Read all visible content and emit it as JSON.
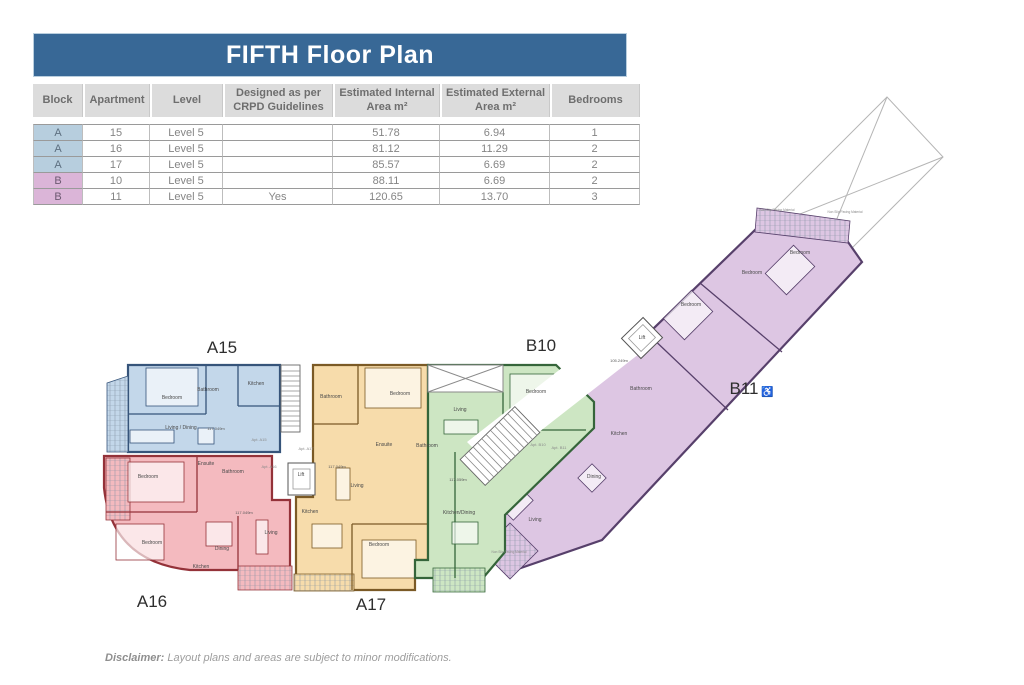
{
  "title": "FIFTH Floor Plan",
  "colors": {
    "titlebar": "#386896",
    "blockA": "#b7cede",
    "blockB": "#dbb5d8"
  },
  "table": {
    "headers": [
      "Block",
      "Apartment",
      "Level",
      "Designed as per CRPD Guidelines",
      "Estimated Internal Area m²",
      "Estimated External Area m²",
      "Bedrooms"
    ],
    "col_widths": [
      50,
      67,
      73,
      110,
      107,
      110,
      90
    ],
    "rows": [
      {
        "block": "A",
        "apartment": "15",
        "level": "Level 5",
        "crpd": "",
        "internal": "51.78",
        "external": "6.94",
        "bedrooms": "1"
      },
      {
        "block": "A",
        "apartment": "16",
        "level": "Level 5",
        "crpd": "",
        "internal": "81.12",
        "external": "11.29",
        "bedrooms": "2"
      },
      {
        "block": "A",
        "apartment": "17",
        "level": "Level 5",
        "crpd": "",
        "internal": "85.57",
        "external": "6.69",
        "bedrooms": "2"
      },
      {
        "block": "B",
        "apartment": "10",
        "level": "Level 5",
        "crpd": "",
        "internal": "88.11",
        "external": "6.69",
        "bedrooms": "2"
      },
      {
        "block": "B",
        "apartment": "11",
        "level": "Level 5",
        "crpd": "Yes",
        "internal": "120.65",
        "external": "13.70",
        "bedrooms": "3"
      }
    ]
  },
  "plan": {
    "apartments": [
      {
        "id": "A15",
        "label": "A15",
        "fill": "#c3d7ea",
        "wall": "#36547a",
        "lx": 222,
        "ly": 353
      },
      {
        "id": "A16",
        "label": "A16",
        "fill": "#f4babf",
        "wall": "#943239",
        "lx": 152,
        "ly": 607
      },
      {
        "id": "A17",
        "label": "A17",
        "fill": "#f7dcab",
        "wall": "#7b5a26",
        "lx": 371,
        "ly": 610
      },
      {
        "id": "B10",
        "label": "B10",
        "fill": "#cde6c3",
        "wall": "#35653a",
        "lx": 541,
        "ly": 351
      },
      {
        "id": "B11",
        "label": "B11",
        "icon": "♿",
        "fill": "#ddc6e3",
        "wall": "#57406b",
        "lx": 744,
        "ly": 394
      }
    ],
    "annotations": [
      {
        "t": "Bedroom",
        "x": 172,
        "y": 399,
        "c": "room"
      },
      {
        "t": "Bathroom",
        "x": 208,
        "y": 391,
        "c": "room"
      },
      {
        "t": "Kitchen",
        "x": 256,
        "y": 385,
        "c": "room"
      },
      {
        "t": "Living / Dining",
        "x": 181,
        "y": 429,
        "c": "room"
      },
      {
        "t": "Bedroom",
        "x": 148,
        "y": 478,
        "c": "room"
      },
      {
        "t": "Ensuite",
        "x": 206,
        "y": 465,
        "c": "room"
      },
      {
        "t": "Bathroom",
        "x": 233,
        "y": 473,
        "c": "room"
      },
      {
        "t": "Bedroom",
        "x": 152,
        "y": 544,
        "c": "room"
      },
      {
        "t": "Dining",
        "x": 222,
        "y": 550,
        "c": "room"
      },
      {
        "t": "Kitchen",
        "x": 201,
        "y": 568,
        "c": "room"
      },
      {
        "t": "Living",
        "x": 271,
        "y": 534,
        "c": "room"
      },
      {
        "t": "Bathroom",
        "x": 331,
        "y": 398,
        "c": "room"
      },
      {
        "t": "Bedroom",
        "x": 400,
        "y": 395,
        "c": "room"
      },
      {
        "t": "Ensuite",
        "x": 384,
        "y": 446,
        "c": "room"
      },
      {
        "t": "Living",
        "x": 357,
        "y": 487,
        "c": "room"
      },
      {
        "t": "Kitchen",
        "x": 310,
        "y": 513,
        "c": "room"
      },
      {
        "t": "Bedroom",
        "x": 379,
        "y": 546,
        "c": "room"
      },
      {
        "t": "Bedroom",
        "x": 536,
        "y": 393,
        "c": "room"
      },
      {
        "t": "Living",
        "x": 460,
        "y": 411,
        "c": "room"
      },
      {
        "t": "Bathroom",
        "x": 427,
        "y": 447,
        "c": "room"
      },
      {
        "t": "Kitchen/Dining",
        "x": 459,
        "y": 514,
        "c": "room"
      },
      {
        "t": "Bedroom",
        "x": 691,
        "y": 306,
        "c": "room"
      },
      {
        "t": "Bedroom",
        "x": 752,
        "y": 274,
        "c": "room"
      },
      {
        "t": "Bedroom",
        "x": 800,
        "y": 254,
        "c": "room"
      },
      {
        "t": "Bathroom",
        "x": 641,
        "y": 390,
        "c": "room"
      },
      {
        "t": "Kitchen",
        "x": 619,
        "y": 435,
        "c": "room"
      },
      {
        "t": "Dining",
        "x": 594,
        "y": 478,
        "c": "room"
      },
      {
        "t": "Living",
        "x": 535,
        "y": 521,
        "c": "room"
      },
      {
        "t": "Lift",
        "x": 301,
        "y": 476,
        "c": "room"
      },
      {
        "t": "Lift",
        "x": 642,
        "y": 339,
        "c": "room"
      },
      {
        "t": "Apt. A15",
        "x": 259,
        "y": 441,
        "c": "door"
      },
      {
        "t": "Apt. A17",
        "x": 306,
        "y": 450,
        "c": "door"
      },
      {
        "t": "Apt. A16",
        "x": 269,
        "y": 468,
        "c": "door"
      },
      {
        "t": "Apt. B10",
        "x": 538,
        "y": 446,
        "c": "door"
      },
      {
        "t": "Apt. B11",
        "x": 559,
        "y": 449,
        "c": "door"
      },
      {
        "t": "117.049m",
        "x": 216,
        "y": 430,
        "c": "marker"
      },
      {
        "t": "117.049m",
        "x": 244,
        "y": 514,
        "c": "marker"
      },
      {
        "t": "117.049m",
        "x": 337,
        "y": 468,
        "c": "marker"
      },
      {
        "t": "117.059m",
        "x": 458,
        "y": 481,
        "c": "marker"
      },
      {
        "t": "105.249m",
        "x": 619,
        "y": 362,
        "c": "marker"
      },
      {
        "t": "Non Slip Paving Material",
        "x": 777,
        "y": 211,
        "c": "terrace"
      },
      {
        "t": "Non Slip Paving Material",
        "x": 845,
        "y": 213,
        "c": "terrace"
      },
      {
        "t": "Non Slip Paving Material",
        "x": 509,
        "y": 553,
        "c": "terrace"
      }
    ]
  },
  "disclaimer": {
    "prefix": "Disclaimer:",
    "text": " Layout plans and areas are subject to minor modifications."
  }
}
